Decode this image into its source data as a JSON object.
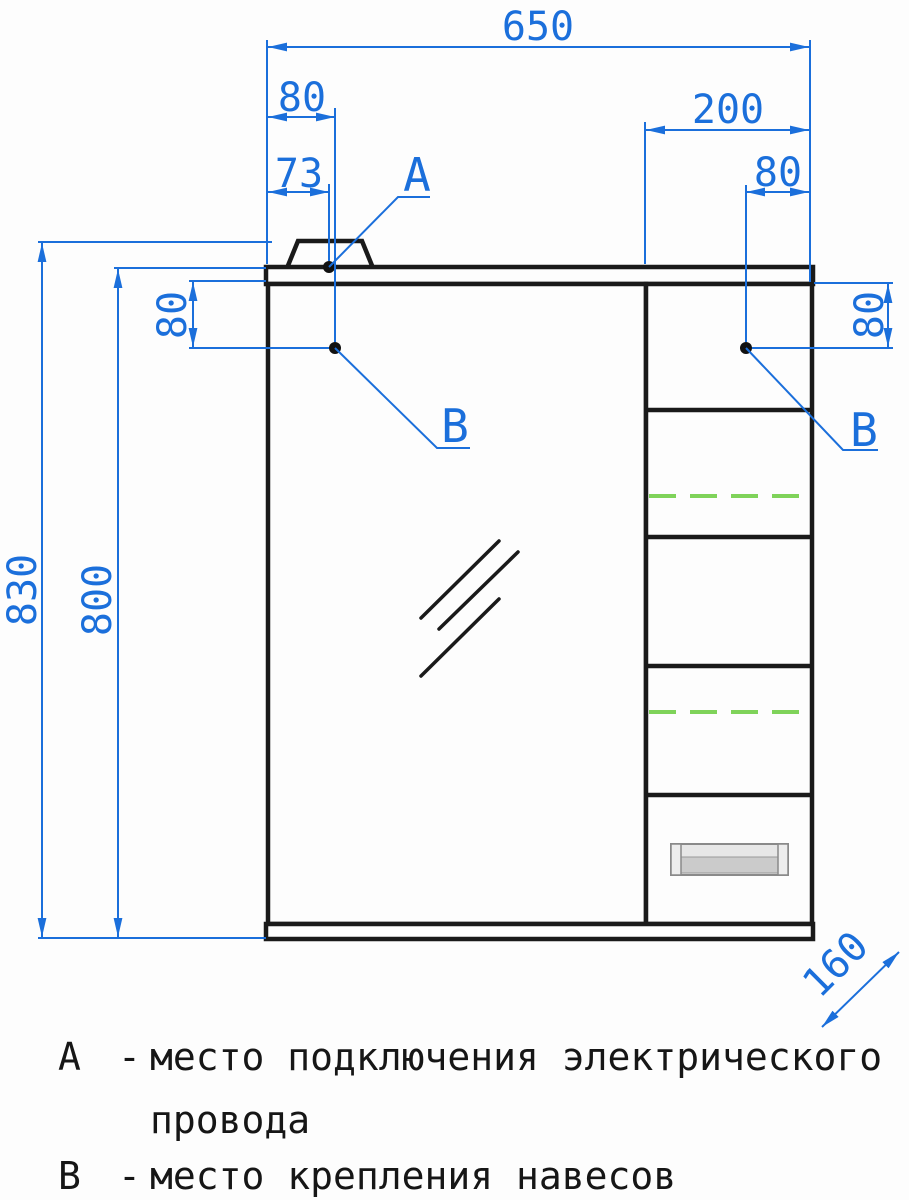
{
  "drawing_type": "furniture technical drawing (mirror cabinet, front view)",
  "dimensions": {
    "overall_width": "650",
    "top_left_offset_80": "80",
    "power_point_offset_73": "73",
    "right_section_width_200": "200",
    "top_right_offset_80": "80",
    "overall_height_830": "830",
    "body_height_800": "800",
    "left_hinge_drop_80": "80",
    "right_hinge_drop_80": "80",
    "depth_160": "160"
  },
  "callouts": {
    "a": "А",
    "b_left": "В",
    "b_right": "В"
  },
  "legend": {
    "a_letter": "А",
    "a_sep": "-",
    "a_text": "место подключения электрического",
    "a_text_cont": "провода",
    "b_letter": "В",
    "b_sep": "-",
    "b_text": "место крепления навесов"
  },
  "colors": {
    "dimension_blue": "#1b6fdb",
    "outline_black": "#1a1a1a",
    "shelf_marker_green": "#7fd35a",
    "handle_gray": "#c9c9c9"
  }
}
